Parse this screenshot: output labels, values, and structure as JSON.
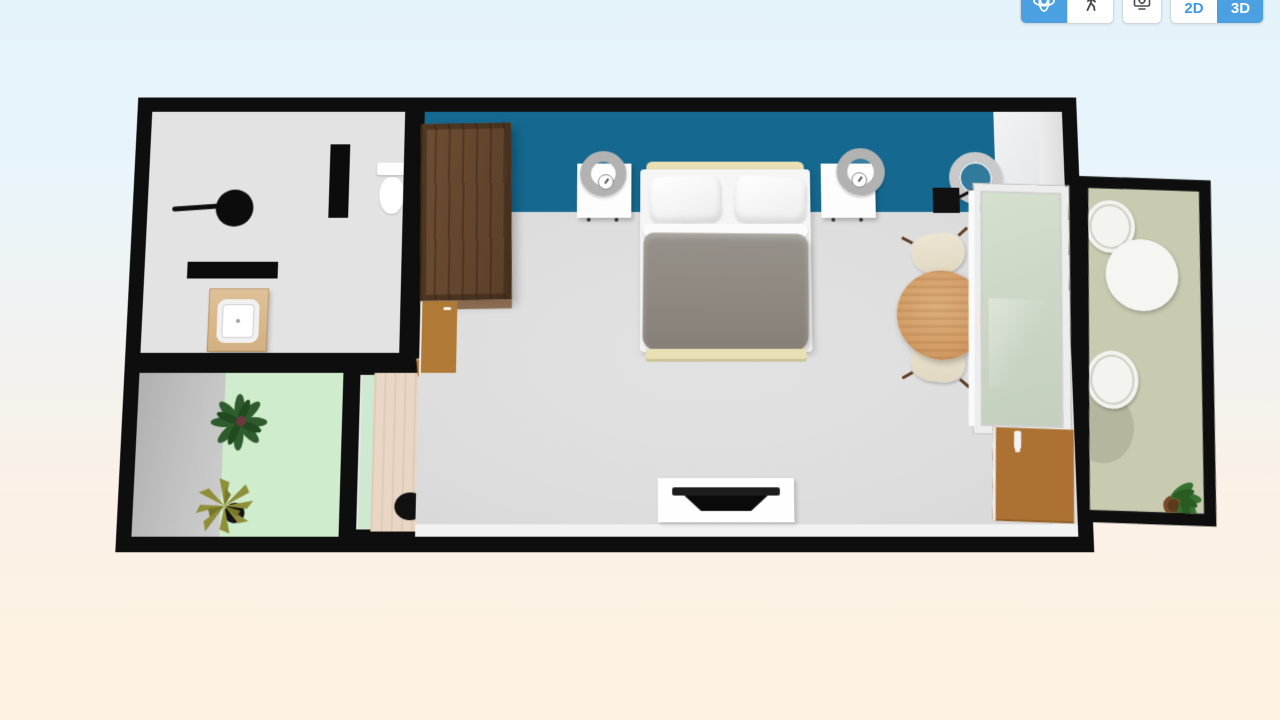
{
  "app": {
    "name": "3D floor plan viewer",
    "view_mode": "3D"
  },
  "toolbar": {
    "accent_color": "#4aa0e0",
    "buttons": [
      {
        "id": "orbit",
        "icon": "orbit-icon",
        "active": true
      },
      {
        "id": "walk",
        "icon": "walk-icon",
        "active": false
      },
      {
        "id": "screenshot",
        "icon": "screenshot-icon",
        "active": false
      },
      {
        "id": "view-2d",
        "label": "2D",
        "active": false
      },
      {
        "id": "view-3d",
        "label": "3D",
        "active": true
      }
    ],
    "view_2d_label": "2D",
    "view_3d_label": "3D"
  },
  "colors": {
    "background_top": "#e4f2fa",
    "background_bottom": "#fef2e3",
    "wall_black": "#0e0e0e",
    "bedroom_accent_wall": "#15688f",
    "bedroom_floor": "#dedede",
    "bathroom_floor": "#e3e3e3",
    "patio_floor_green": "#cfeccd",
    "hallway_floor_wood": "#e9d6c5",
    "balcony_floor_olive": "#c9cbb1",
    "wardrobe_wood": "#63452c",
    "door_wood": "#ad7233",
    "dining_table_wood": "#d29c66",
    "duvet_gray": "#8e8880",
    "bed_frame_cream": "#e9dfb5"
  },
  "floor_plan": {
    "rooms": [
      {
        "name": "bathroom",
        "items": [
          "shower-head",
          "shower-partition-wall",
          "toilet",
          "counter",
          "vanity-with-sink"
        ]
      },
      {
        "name": "patio",
        "items": [
          "monstera-plant",
          "yucca-plant"
        ]
      },
      {
        "name": "hallway",
        "items": [
          "glass-door",
          "open-door",
          "floor-pot",
          "wall-panel"
        ]
      },
      {
        "name": "bedroom",
        "items": [
          "wardrobe",
          "bathroom-door",
          "double-bed",
          "pillows",
          "nightstand-left",
          "table-lamp-left",
          "alarm-clock-left",
          "nightstand-right",
          "table-lamp-right",
          "alarm-clock-right",
          "ceiling-lamp",
          "wall-mounted-unit",
          "dining-table",
          "dining-chair-top",
          "dining-chair-bottom",
          "window",
          "entrance-door",
          "tv-stand",
          "tv"
        ]
      },
      {
        "name": "balcony",
        "items": [
          "round-table",
          "lounge-chair-top",
          "lounge-chair-bottom",
          "potted-plant"
        ]
      }
    ]
  }
}
